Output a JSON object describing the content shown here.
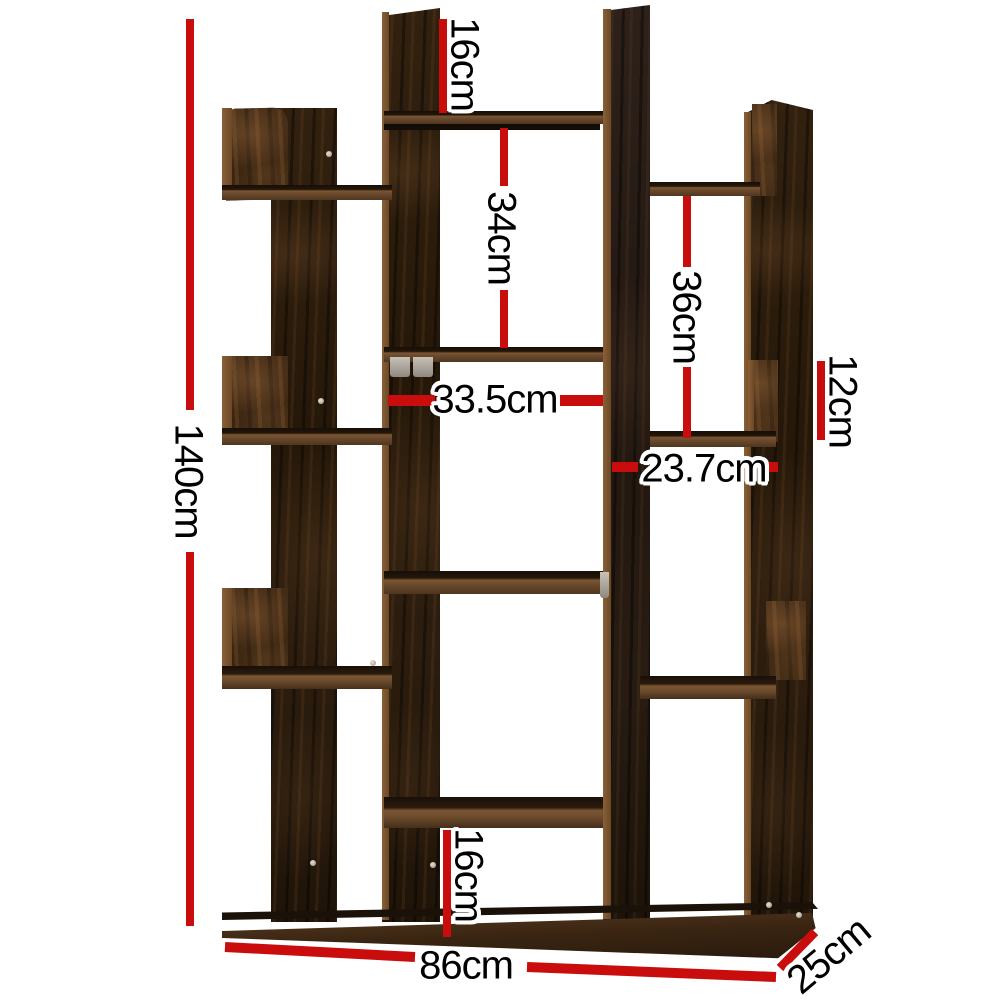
{
  "diagram": {
    "kind": "product-dimension-diagram",
    "subject": "rustic dark wood tree-style bookshelf with offset open shelves",
    "background": "#ffffff"
  },
  "labels": {
    "height": "140cm",
    "top_gap": "16cm",
    "upper_opening": "34cm",
    "right_opening": "36cm",
    "right_niche": "12cm",
    "center_width": "33.5cm",
    "right_width": "23.7cm",
    "bottom_opening": "16cm",
    "base_width": "86cm",
    "depth": "25cm"
  },
  "dimensions_cm": {
    "height": 140,
    "top_gap": 16,
    "upper_opening": 34,
    "right_opening": 36,
    "right_niche": 12,
    "center_width": 33.5,
    "right_width": 23.7,
    "bottom_opening": 16,
    "base_width": 86,
    "depth": 25
  },
  "colors": {
    "dimension_line": "#c90d0d",
    "label_text": "#000000",
    "label_outline": "#ffffff",
    "wood_dark": "#261a11",
    "wood_mid": "#432f1e",
    "wood_edge": "#7d5a38"
  }
}
